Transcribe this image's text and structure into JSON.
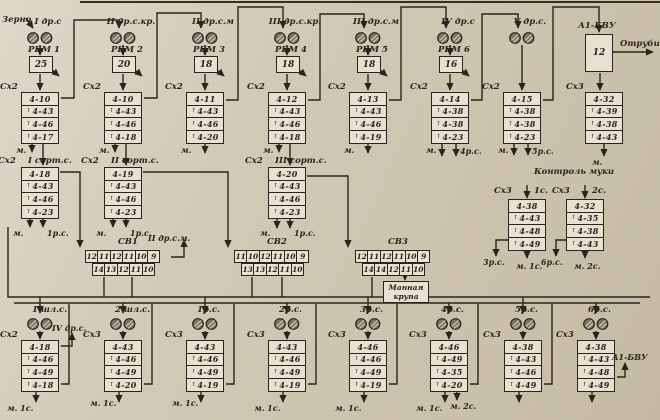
{
  "colors": {
    "background": "#cfc6b2",
    "ink": "#2a241c",
    "box_fill": "#e7e1d1"
  },
  "static_labels": {
    "grain": "Зерно",
    "bran": "Отруби",
    "a1bvu_unit": "А1-БВУ",
    "a1bvu_value": "12",
    "semolina_line1": "Манная",
    "semolina_line2": "крупа"
  },
  "top_systems": [
    {
      "system": "I др.с",
      "machine": "РБМ 1",
      "machine_value": "25",
      "sifter": "Сх2",
      "cells": [
        "4-10",
        "4-43",
        "4-46",
        "4-17"
      ],
      "out_left": "м.",
      "out_right": ""
    },
    {
      "system": "II др.с.кр.",
      "machine": "РБМ 2",
      "machine_value": "20",
      "sifter": "Сх2",
      "cells": [
        "4-10",
        "4-43",
        "4-46",
        "4-18"
      ],
      "out_left": "м.",
      "out_right": ""
    },
    {
      "system": "II др.с.м",
      "machine": "РБМ 3",
      "machine_value": "18",
      "sifter": "Сх2",
      "cells": [
        "4-11",
        "4-43",
        "4-46",
        "4-20"
      ],
      "out_left": "м.",
      "out_right": ""
    },
    {
      "system": "III др.с.кр.",
      "machine": "РБМ 4",
      "machine_value": "18",
      "sifter": "Сх2",
      "cells": [
        "4-12",
        "4-43",
        "4-46",
        "4-18"
      ],
      "out_left": "м.",
      "out_right": ""
    },
    {
      "system": "III др.с.м",
      "machine": "РБМ 5",
      "machine_value": "18",
      "sifter": "Сх2",
      "cells": [
        "4-13",
        "4-43",
        "4-46",
        "4-19"
      ],
      "out_left": "м.",
      "out_right": ""
    },
    {
      "system": "IV др.с",
      "machine": "РБМ 6",
      "machine_value": "16",
      "sifter": "Сх2",
      "cells": [
        "4-14",
        "4-38",
        "4-38",
        "4-23"
      ],
      "out_left": "м.",
      "out_right": "4р.с."
    },
    {
      "system": "V др.с.",
      "machine": "",
      "machine_value": "",
      "sifter": "Сх2",
      "cells": [
        "4-15",
        "4-38",
        "4-38",
        "4-23"
      ],
      "out_left": "м.",
      "out_right": "5р.с."
    }
  ],
  "bran_unit": {
    "name": "А1-БВУ",
    "value": "12",
    "output": "Отруби",
    "sifter": "Сх3",
    "cells": [
      "4-32",
      "4-39",
      "4-38",
      "4-43"
    ],
    "out": "м."
  },
  "sort_systems": [
    {
      "sifter": "Сх2",
      "system": "I сорт.с.",
      "cells": [
        "4-18",
        "4-43",
        "4-46",
        "4-23"
      ],
      "out_left": "м.",
      "out_right": "1р.с."
    },
    {
      "sifter": "Сх2",
      "system": "II сорт.с.",
      "cells": [
        "4-19",
        "4-43",
        "4-46",
        "4-23"
      ],
      "out_left": "м.",
      "out_right": "1р.с."
    },
    {
      "sifter": "Сх2",
      "system": "III сорт.с.",
      "cells": [
        "4-20",
        "4-43",
        "4-46",
        "4-23"
      ],
      "out_left": "м.",
      "out_right": "1р.с."
    }
  ],
  "purifiers": [
    {
      "name": "СВ1",
      "row1": [
        "12",
        "11",
        "12",
        "11",
        "10",
        "9"
      ],
      "row2": [
        "14",
        "13",
        "12",
        "11",
        "10"
      ],
      "note": "II др.с.м."
    },
    {
      "name": "СВ2",
      "row1": [
        "11",
        "10",
        "12",
        "11",
        "10",
        "9"
      ],
      "row2": [
        "13",
        "13",
        "12",
        "11",
        "10"
      ],
      "note": ""
    },
    {
      "name": "СВ3",
      "row1": [
        "12",
        "11",
        "12",
        "11",
        "10",
        "9"
      ],
      "row2": [
        "14",
        "14",
        "12",
        "11",
        "10"
      ],
      "note": ""
    }
  ],
  "flour_control": {
    "title": "Контроль муки",
    "units": [
      {
        "sifter": "Сх3",
        "grade": "1с.",
        "cells": [
          "4-38",
          "4-43",
          "4-48",
          "4-49"
        ],
        "out_left": "3р.с.",
        "out_down": "м. 1с."
      },
      {
        "sifter": "Сх3",
        "grade": "2с.",
        "cells": [
          "4-32",
          "4-35",
          "4-38",
          "4-43"
        ],
        "out_left": "6р.с.",
        "out_down": "м. 2с."
      }
    ]
  },
  "bottom_systems": [
    {
      "system": "1 шл.с.",
      "sifter": "Сх2",
      "cells": [
        "4-18",
        "4-46",
        "4-49",
        "4-18"
      ],
      "out": "м. 1с.",
      "out2": "",
      "note": "IV др.с."
    },
    {
      "system": "2 шл.с.",
      "sifter": "Сх3",
      "cells": [
        "4-43",
        "4-46",
        "4-49",
        "4-20"
      ],
      "out": "м. 1с.",
      "out2": "",
      "note": ""
    },
    {
      "system": "1р.с.",
      "sifter": "Сх3",
      "cells": [
        "4-43",
        "4-46",
        "4-49",
        "4-19"
      ],
      "out": "м. 1с.",
      "out2": "",
      "note": ""
    },
    {
      "system": "2р.с.",
      "sifter": "Сх3",
      "cells": [
        "4-43",
        "4-46",
        "4-49",
        "4-19"
      ],
      "out": "м. 1с.",
      "out2": "",
      "note": ""
    },
    {
      "system": "3р.с.",
      "sifter": "Сх3",
      "cells": [
        "4-46",
        "4-46",
        "4-49",
        "4-19"
      ],
      "out": "м. 1с.",
      "out2": "",
      "note": ""
    },
    {
      "system": "4р.с.",
      "sifter": "Сх3",
      "cells": [
        "4-46",
        "4-49",
        "4-35",
        "4-20"
      ],
      "out": "м. 1с.",
      "out2": "м. 2с.",
      "note": ""
    },
    {
      "system": "5р.с.",
      "sifter": "Сх3",
      "cells": [
        "4-38",
        "4-43",
        "4-46",
        "4-49"
      ],
      "out": "",
      "out2": "",
      "note": ""
    },
    {
      "system": "6р.с.",
      "sifter": "Сх3",
      "cells": [
        "4-38",
        "4-43",
        "4-48",
        "4-49"
      ],
      "out": "",
      "out2": "",
      "note": "А1-БВУ"
    }
  ]
}
